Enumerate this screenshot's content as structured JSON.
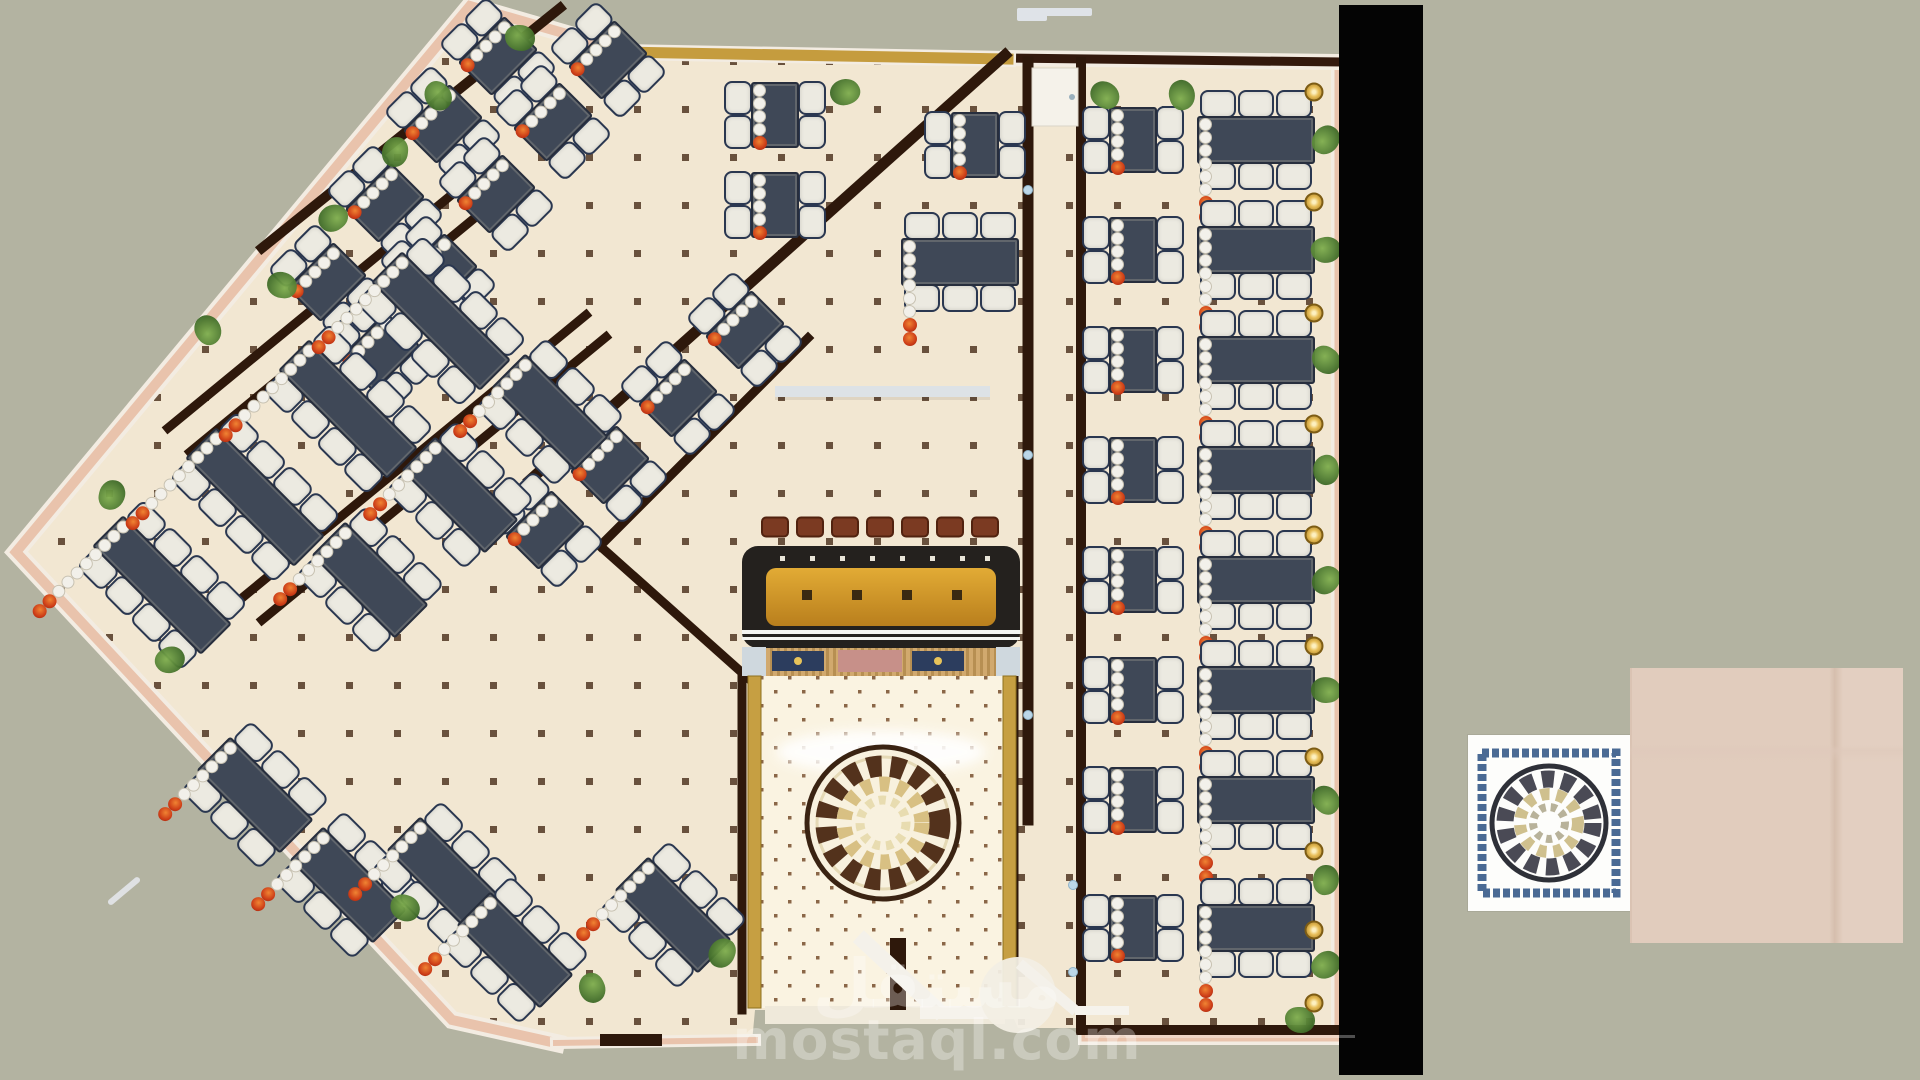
{
  "title": "Restaurant interior top-view floor plan render",
  "watermark": {
    "arabic": "مستقل",
    "latin": "mostaql.com"
  },
  "palette": {
    "background": "#b3b3a1",
    "floor": "#f2e7d2",
    "floor_dot": "#3f2410",
    "interior_wall": "#2e180b",
    "outer_wall_pink": "#e9c3ac",
    "gold_trim": "#c59c3e",
    "table_navy": "#3f4857",
    "chair_white": "#eceae1",
    "flower_red": "#cc3c17",
    "bar_counter": "#24211e",
    "bar_floor_amber": "#d9a12e",
    "stool_brown": "#7b3a22",
    "plant_green": "#4f7a30",
    "lobby_floor": "#faf3e1",
    "medallion_dark": "#53321c",
    "medallion_tan": "#d8c083",
    "black_panel": "#040404",
    "wood_sample": "#ecdcd0",
    "tile_frame_blue": "#4a6a94"
  },
  "scene": {
    "tables": [
      [
        "t4",
        327,
        282,
        45
      ],
      [
        "t4",
        385,
        203,
        45
      ],
      [
        "t4",
        443,
        124,
        45
      ],
      [
        "t4",
        498,
        56,
        45
      ],
      [
        "t4",
        380,
        352,
        45
      ],
      [
        "t4",
        438,
        273,
        45
      ],
      [
        "t4",
        496,
        194,
        45
      ],
      [
        "t4",
        553,
        122,
        45
      ],
      [
        "t4",
        608,
        60,
        45
      ],
      [
        "t4",
        745,
        330,
        45
      ],
      [
        "t4",
        678,
        398,
        45
      ],
      [
        "t4",
        610,
        465,
        45
      ],
      [
        "t4",
        545,
        530,
        45
      ],
      [
        "t8",
        162,
        585,
        45
      ],
      [
        "t8",
        255,
        497,
        45
      ],
      [
        "t8",
        348,
        409,
        45
      ],
      [
        "t8",
        441,
        321,
        45
      ],
      [
        "t6",
        370,
        580,
        45
      ],
      [
        "t6",
        460,
        495,
        45
      ],
      [
        "t6",
        550,
        412,
        45
      ],
      [
        "t6",
        255,
        795,
        45
      ],
      [
        "t6",
        348,
        885,
        45
      ],
      [
        "t6",
        445,
        875,
        45
      ],
      [
        "t6",
        515,
        950,
        45
      ],
      [
        "t6",
        673,
        915,
        45
      ],
      [
        "t4",
        775,
        115,
        0
      ],
      [
        "t4",
        775,
        205,
        0
      ],
      [
        "t4",
        975,
        145,
        0
      ],
      [
        "t6",
        960,
        262,
        0
      ],
      [
        "t4",
        1133,
        140,
        0
      ],
      [
        "t4",
        1133,
        250,
        0
      ],
      [
        "t4",
        1133,
        360,
        0
      ],
      [
        "t4",
        1133,
        470,
        0
      ],
      [
        "t4",
        1133,
        580,
        0
      ],
      [
        "t4",
        1133,
        690,
        0
      ],
      [
        "t4",
        1133,
        800,
        0
      ],
      [
        "t4",
        1133,
        928,
        0
      ],
      [
        "t6",
        1256,
        140,
        0
      ],
      [
        "t6",
        1256,
        250,
        0
      ],
      [
        "t6",
        1256,
        360,
        0
      ],
      [
        "t6",
        1256,
        470,
        0
      ],
      [
        "t6",
        1256,
        580,
        0
      ],
      [
        "t6",
        1256,
        690,
        0
      ],
      [
        "t6",
        1256,
        800,
        0
      ],
      [
        "t6",
        1256,
        928,
        0
      ]
    ],
    "plants": [
      [
        520,
        38
      ],
      [
        438,
        96
      ],
      [
        395,
        152
      ],
      [
        333,
        218
      ],
      [
        282,
        285
      ],
      [
        208,
        330
      ],
      [
        112,
        495
      ],
      [
        170,
        660
      ],
      [
        405,
        908
      ],
      [
        592,
        988
      ],
      [
        722,
        953
      ],
      [
        845,
        92
      ],
      [
        1105,
        95
      ],
      [
        1182,
        95
      ],
      [
        1326,
        140
      ],
      [
        1326,
        250
      ],
      [
        1326,
        360
      ],
      [
        1326,
        470
      ],
      [
        1326,
        580
      ],
      [
        1326,
        690
      ],
      [
        1326,
        800
      ],
      [
        1326,
        880
      ],
      [
        1326,
        965
      ],
      [
        1300,
        1020
      ]
    ],
    "lamps": {
      "x": 1314,
      "ys": [
        92,
        202,
        313,
        424,
        535,
        646,
        757,
        851,
        930,
        1003
      ]
    },
    "stools": {
      "y": 527,
      "xs": [
        775,
        810,
        845,
        880,
        915,
        950,
        985
      ]
    },
    "wall_dots": [
      [
        1028,
        190
      ],
      [
        1028,
        455
      ],
      [
        1028,
        715
      ],
      [
        1073,
        885
      ],
      [
        1073,
        972
      ]
    ]
  }
}
